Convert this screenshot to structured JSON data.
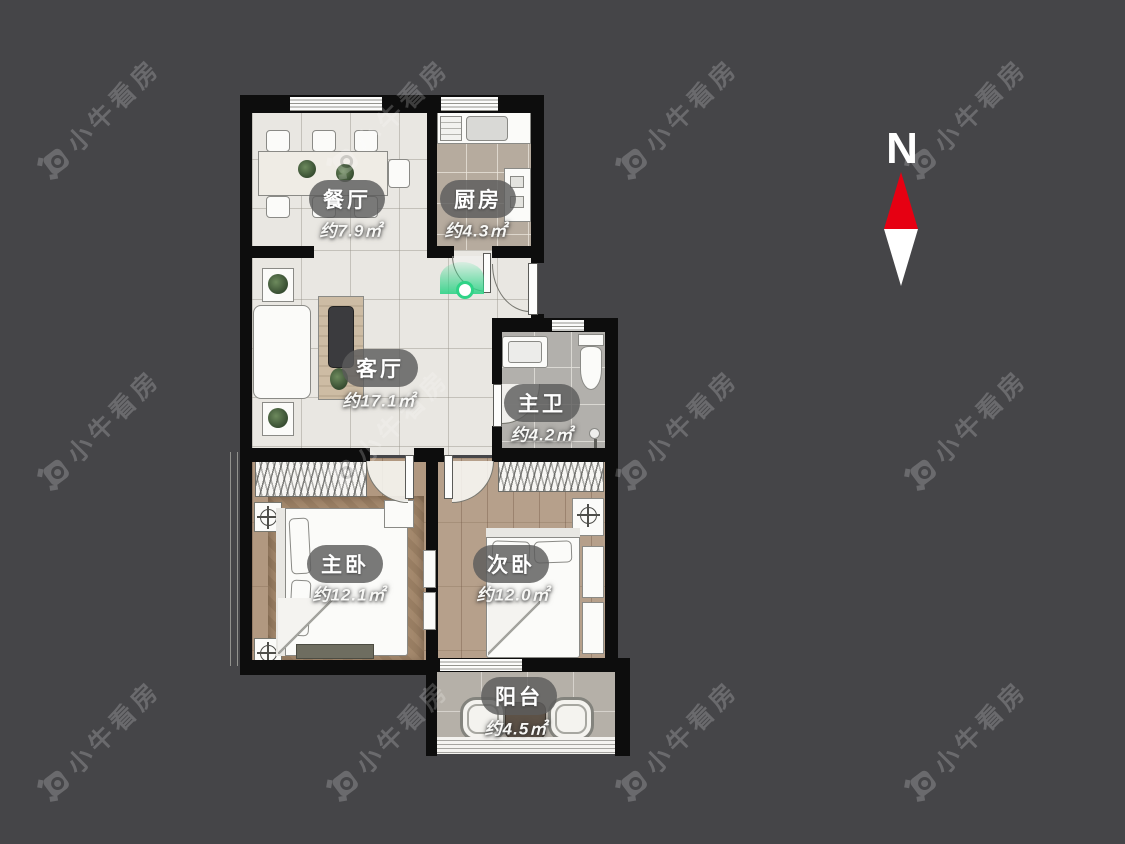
{
  "title": "户型图",
  "compass": {
    "label": "N"
  },
  "watermark": {
    "text": "小牛看房"
  },
  "rooms": {
    "dining": {
      "name": "餐厅",
      "area": "约7.9㎡"
    },
    "kitchen": {
      "name": "厨房",
      "area": "约4.3㎡"
    },
    "living": {
      "name": "客厅",
      "area": "约17.1㎡"
    },
    "master_bath": {
      "name": "主卫",
      "area": "约4.2㎡"
    },
    "master_bedroom": {
      "name": "主卧",
      "area": "约12.1㎡"
    },
    "second_bedroom": {
      "name": "次卧",
      "area": "约12.0㎡"
    },
    "balcony": {
      "name": "阳台",
      "area": "约4.5㎡"
    }
  },
  "colors": {
    "background": "#454548",
    "wall": "#0d0d0d",
    "north_arrow_red": "#e60012",
    "entry_marker_green": "#2fd387"
  }
}
